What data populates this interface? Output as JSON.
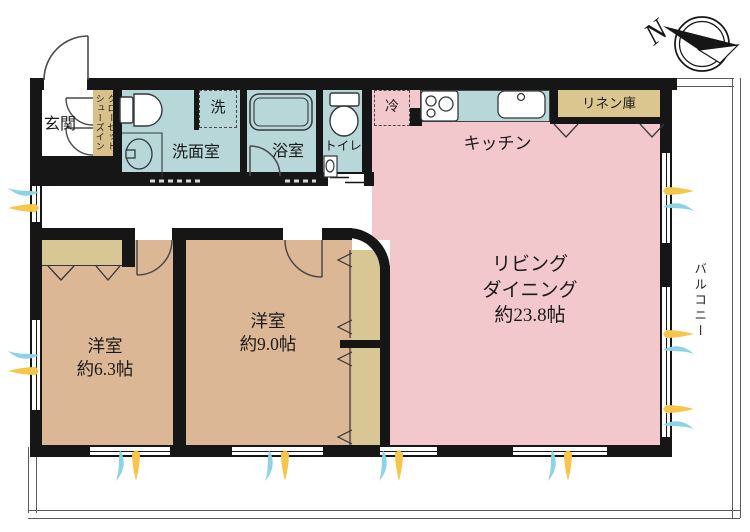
{
  "plan_type": "floor-plan",
  "compass": {
    "north_label": "N"
  },
  "colors": {
    "living_pink": "#f2c8cc",
    "bedroom_tan": "#dcb795",
    "wet_area_blue": "#b7d7d9",
    "storage_khaki": "#dcc690",
    "shoes_closet_khaki": "#d8c08a",
    "wall_black": "#161616",
    "sunlight_yellow": "#f6c64b",
    "breeze_cyan": "#8cd4e4"
  },
  "rooms": {
    "genkan": {
      "label": "玄関"
    },
    "shoes_closet": {
      "column_right": "シューズイン",
      "column_left": "クローゼット"
    },
    "washroom": {
      "label": "洗面室"
    },
    "laundry": {
      "label": "洗"
    },
    "bathroom": {
      "label": "浴室"
    },
    "toilet": {
      "label": "トイレ"
    },
    "fridge": {
      "label": "冷"
    },
    "kitchen": {
      "label": "キッチン"
    },
    "linen": {
      "label": "リネン庫"
    },
    "living_dining": {
      "line1": "リビング",
      "line2": "ダイニング",
      "line3": "約23.8帖",
      "area_jo": "23.8"
    },
    "bedroom_9": {
      "line1": "洋室",
      "line2": "約9.0帖",
      "area_jo": "9.0"
    },
    "bedroom_6": {
      "line1": "洋室",
      "line2": "約6.3帖",
      "area_jo": "6.3"
    },
    "balcony": {
      "label": "バルコニー"
    }
  }
}
